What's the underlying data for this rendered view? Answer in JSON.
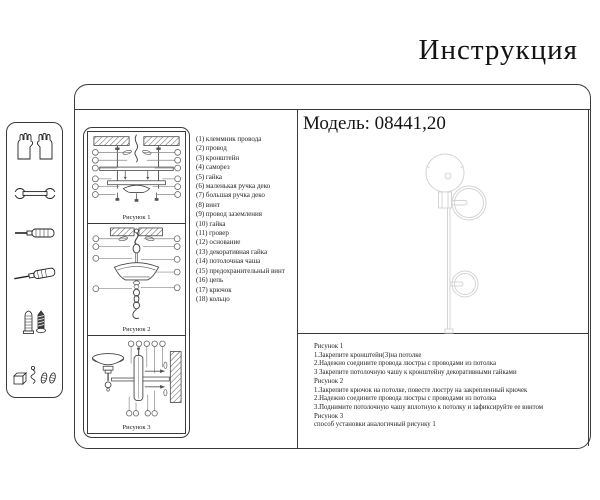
{
  "title": "Инструкция",
  "model": {
    "label": "Модель: 08441,20"
  },
  "colors": {
    "ink": "#1c1c1c",
    "border": "#3a3a3a",
    "diagram_line": "#555555",
    "leader_line": "#888888",
    "faint_drawing": "#d4d4d4"
  },
  "sidebar_tools": {
    "icons": [
      "gloves-icon",
      "wrench-icon",
      "screwdriver-icon",
      "screwdriver-angled-icon",
      "wall-plug-and-screw-icon",
      "hardware-parts-icon"
    ]
  },
  "parts": {
    "items": [
      "(1) клеммник провода",
      "(2) провод",
      "(3) кронштейн",
      "(4) саморез",
      "(5) гайка",
      "(6) маленькая ручка деко",
      "(7) большая ручка деко",
      "(8) винт",
      "(9) провод заземления",
      "(10) гайка",
      "(11) гровер",
      "(12) основание",
      "(13) декоративная гайка",
      "(14) потолочная чаша",
      "(15) предохранительный винт",
      "(16) цепь",
      "(17) крючок",
      "(18) кольцо"
    ]
  },
  "figures": {
    "fig1": {
      "caption": "Рисунок 1"
    },
    "fig2": {
      "caption": "Рисунок 2"
    },
    "fig3": {
      "caption": "Рисунок 3"
    }
  },
  "instructions": {
    "lines": [
      "Рисунок 1",
      "1.Закрепите кронштейн(3)на потолке",
      "2.Надежно соедините провода люстры с проводами из потолка",
      "3 Закрепите потолочную чашу к кронштейну декоративными гайками",
      "Рисунок 2",
      "1.Закрепите крючок на потолке, повесте люстру на закрепленный крючек",
      "2.Надежно соедините провода люстры с проводами из потолка",
      "3.Поднимите потолочную чашу вплотную к потолку и зафиксируйте ее винтом",
      "Рисунок 3",
      "способ установки аналогичный рисунку 1"
    ]
  }
}
